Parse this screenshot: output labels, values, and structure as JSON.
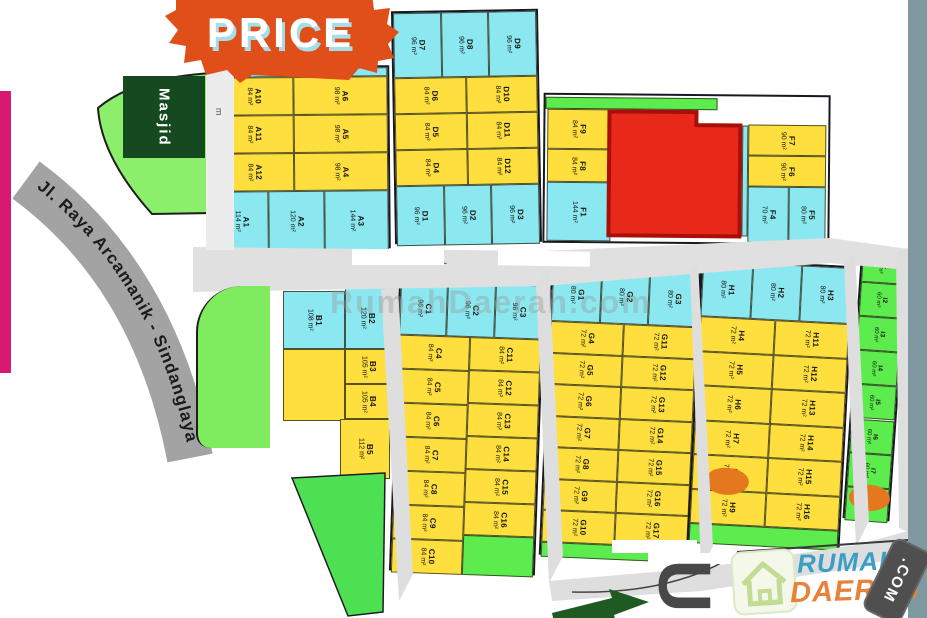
{
  "badge": {
    "label": "PRICE"
  },
  "landmarks": {
    "mosque": "Masjid",
    "main_road": "Jl. Raya Arcamanik - Sindanglaya",
    "north_label": "U",
    "road_width_label": "m"
  },
  "watermark": "RumahDaerah.com",
  "logo": {
    "word1": "RUMAH",
    "word2": "DAERAH",
    "tld": ".COM"
  },
  "colors": {
    "yellow_plot": "#FFDF3D",
    "cyan_plot": "#8BE8F0",
    "green_plot": "#5CEC4E",
    "sold_red": "#E8291A",
    "orange_marker": "#E5771E",
    "banner_orange": "#E04E1A",
    "magenta_bar": "#D9186F",
    "road_gray": "#A3A3A3",
    "mosque_green": "#15491F"
  },
  "blocks": {
    "A": {
      "cells": [
        {
          "id": "A10",
          "size": "84 m²",
          "tier": "yellow"
        },
        {
          "id": "A6",
          "size": "98 m²",
          "tier": "yellow"
        },
        {
          "id": "A11",
          "size": "84 m²",
          "tier": "yellow"
        },
        {
          "id": "A5",
          "size": "98 m²",
          "tier": "yellow"
        },
        {
          "id": "A12",
          "size": "84 m²",
          "tier": "yellow"
        },
        {
          "id": "A4",
          "size": "98 m²",
          "tier": "yellow"
        },
        {
          "id": "A1",
          "size": "114 m²",
          "tier": "cyan"
        },
        {
          "id": "A2",
          "size": "120 m²",
          "tier": "cyan"
        },
        {
          "id": "A3",
          "size": "144 m²",
          "tier": "cyan"
        }
      ]
    },
    "D": {
      "cells": [
        {
          "id": "D7",
          "size": "96 m²",
          "tier": "cyan"
        },
        {
          "id": "D8",
          "size": "96 m²",
          "tier": "cyan"
        },
        {
          "id": "D9",
          "size": "96 m²",
          "tier": "cyan"
        },
        {
          "id": "D6",
          "size": "84 m²",
          "tier": "yellow"
        },
        {
          "id": "D10",
          "size": "84 m²",
          "tier": "yellow"
        },
        {
          "id": "D5",
          "size": "84 m²",
          "tier": "yellow"
        },
        {
          "id": "D11",
          "size": "84 m²",
          "tier": "yellow"
        },
        {
          "id": "D4",
          "size": "84 m²",
          "tier": "yellow"
        },
        {
          "id": "D12",
          "size": "84 m²",
          "tier": "yellow"
        },
        {
          "id": "D1",
          "size": "96 m²",
          "tier": "cyan"
        },
        {
          "id": "D2",
          "size": "96 m²",
          "tier": "cyan"
        },
        {
          "id": "D3",
          "size": "96 m²",
          "tier": "cyan"
        }
      ]
    },
    "F": {
      "cells": [
        {
          "id": "F9",
          "size": "84 m²",
          "tier": "yellow"
        },
        {
          "id": "F8",
          "size": "84 m²",
          "tier": "yellow"
        },
        {
          "id": "F1",
          "size": "144 m²",
          "tier": "cyan"
        },
        {
          "id": "F7",
          "size": "90 m²",
          "tier": "yellow"
        },
        {
          "id": "F6",
          "size": "90 m²",
          "tier": "yellow"
        },
        {
          "id": "F4",
          "size": "70 m²",
          "tier": "cyan"
        },
        {
          "id": "F5",
          "size": "80 m²",
          "tier": "cyan"
        }
      ]
    },
    "B": {
      "cells": [
        {
          "id": "B1",
          "size": "108 m²",
          "tier": "cyan"
        },
        {
          "id": "B2",
          "size": "120 m²",
          "tier": "cyan"
        },
        {
          "id": "B3",
          "size": "105 m²",
          "tier": "yellow"
        },
        {
          "id": "B4",
          "size": "105 m²",
          "tier": "yellow"
        },
        {
          "id": "B5",
          "size": "112 m²",
          "tier": "yellow"
        }
      ]
    },
    "C": {
      "cells": [
        {
          "id": "C1",
          "size": "96 m²",
          "tier": "cyan"
        },
        {
          "id": "C2",
          "size": "96 m²",
          "tier": "cyan"
        },
        {
          "id": "C3",
          "size": "96 m²",
          "tier": "cyan"
        },
        {
          "id": "C4",
          "size": "84 m²",
          "tier": "yellow"
        },
        {
          "id": "C5",
          "size": "84 m²",
          "tier": "yellow"
        },
        {
          "id": "C6",
          "size": "84 m²",
          "tier": "yellow"
        },
        {
          "id": "C7",
          "size": "84 m²",
          "tier": "yellow"
        },
        {
          "id": "C8",
          "size": "84 m²",
          "tier": "yellow"
        },
        {
          "id": "C9",
          "size": "84 m²",
          "tier": "yellow"
        },
        {
          "id": "C10",
          "size": "84 m²",
          "tier": "yellow"
        },
        {
          "id": "C11",
          "size": "84 m²",
          "tier": "yellow"
        },
        {
          "id": "C12",
          "size": "84 m²",
          "tier": "yellow"
        },
        {
          "id": "C13",
          "size": "84 m²",
          "tier": "yellow"
        },
        {
          "id": "C14",
          "size": "84 m²",
          "tier": "yellow"
        },
        {
          "id": "C15",
          "size": "84 m²",
          "tier": "yellow"
        },
        {
          "id": "C16",
          "size": "84 m²",
          "tier": "yellow"
        }
      ]
    },
    "G": {
      "cells": [
        {
          "id": "G1",
          "size": "80 m²",
          "tier": "cyan"
        },
        {
          "id": "G2",
          "size": "80 m²",
          "tier": "cyan"
        },
        {
          "id": "G3",
          "size": "80 m²",
          "tier": "cyan"
        },
        {
          "id": "G4",
          "size": "72 m²",
          "tier": "yellow"
        },
        {
          "id": "G5",
          "size": "72 m²",
          "tier": "yellow"
        },
        {
          "id": "G6",
          "size": "72 m²",
          "tier": "yellow"
        },
        {
          "id": "G7",
          "size": "72 m²",
          "tier": "yellow"
        },
        {
          "id": "G8",
          "size": "72 m²",
          "tier": "yellow"
        },
        {
          "id": "G9",
          "size": "72 m²",
          "tier": "yellow"
        },
        {
          "id": "G10",
          "size": "72 m²",
          "tier": "yellow"
        },
        {
          "id": "G11",
          "size": "72 m²",
          "tier": "yellow"
        },
        {
          "id": "G12",
          "size": "72 m²",
          "tier": "yellow"
        },
        {
          "id": "G13",
          "size": "72 m²",
          "tier": "yellow"
        },
        {
          "id": "G14",
          "size": "72 m²",
          "tier": "yellow"
        },
        {
          "id": "G15",
          "size": "72 m²",
          "tier": "yellow"
        },
        {
          "id": "G16",
          "size": "72 m²",
          "tier": "yellow"
        },
        {
          "id": "G17",
          "size": "72 m²",
          "tier": "yellow"
        }
      ]
    },
    "H": {
      "cells": [
        {
          "id": "H1",
          "size": "80 m²",
          "tier": "cyan"
        },
        {
          "id": "H2",
          "size": "80 m²",
          "tier": "cyan"
        },
        {
          "id": "H3",
          "size": "80 m²",
          "tier": "cyan"
        },
        {
          "id": "H4",
          "size": "72 m²",
          "tier": "yellow"
        },
        {
          "id": "H5",
          "size": "72 m²",
          "tier": "yellow"
        },
        {
          "id": "H6",
          "size": "72 m²",
          "tier": "yellow"
        },
        {
          "id": "H7",
          "size": "72 m²",
          "tier": "yellow"
        },
        {
          "id": "H8",
          "size": "72 m²",
          "tier": "yellow"
        },
        {
          "id": "H9",
          "size": "72 m²",
          "tier": "yellow"
        },
        {
          "id": "H11",
          "size": "72 m²",
          "tier": "yellow"
        },
        {
          "id": "H12",
          "size": "72 m²",
          "tier": "yellow"
        },
        {
          "id": "H13",
          "size": "72 m²",
          "tier": "yellow"
        },
        {
          "id": "H14",
          "size": "72 m²",
          "tier": "yellow"
        },
        {
          "id": "H15",
          "size": "72 m²",
          "tier": "yellow"
        },
        {
          "id": "H16",
          "size": "72 m²",
          "tier": "yellow"
        }
      ]
    },
    "I": {
      "cells": [
        {
          "id": "I1",
          "size": "60 m²",
          "tier": "green"
        },
        {
          "id": "I2",
          "size": "60 m²",
          "tier": "green"
        },
        {
          "id": "I3",
          "size": "60 m²",
          "tier": "green"
        },
        {
          "id": "I4",
          "size": "60 m²",
          "tier": "green"
        },
        {
          "id": "I5",
          "size": "60 m²",
          "tier": "green"
        },
        {
          "id": "I6",
          "size": "60 m²",
          "tier": "green"
        },
        {
          "id": "I7",
          "size": "60 m²",
          "tier": "green"
        },
        {
          "id": "I8",
          "size": "60 m²",
          "tier": "green"
        }
      ]
    }
  },
  "reserve": {
    "upper": {
      "labels": [
        "R7",
        "R6"
      ],
      "sizes": [
        "65 m²",
        "65 m²"
      ]
    },
    "lower": {
      "labels": [
        "R5",
        "R4",
        "R3",
        "R2",
        "R1"
      ],
      "sizes": [
        "65 m²",
        "65 m²",
        "65 m²",
        "65 m²",
        "65 m²"
      ]
    }
  },
  "sold_markers": [
    "H9",
    "I8"
  ]
}
